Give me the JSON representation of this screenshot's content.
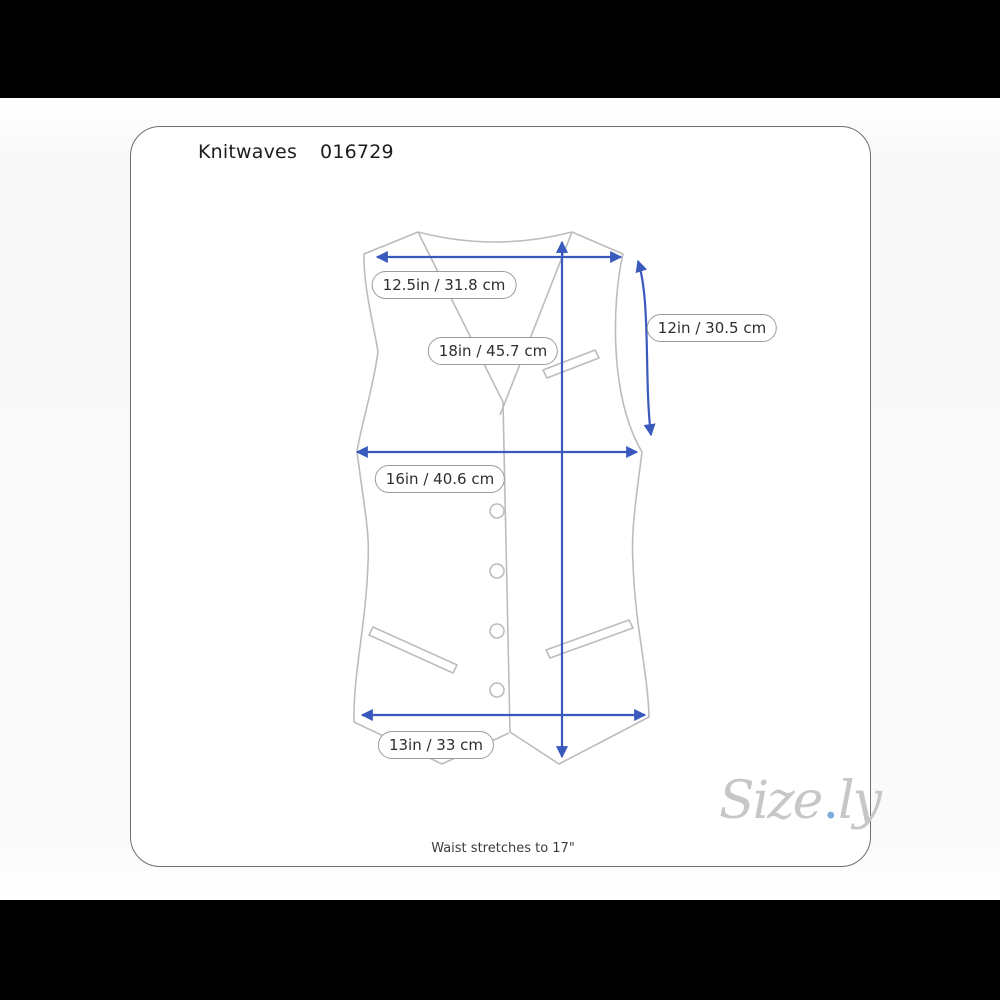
{
  "header": {
    "brand": "Knitwaves",
    "item_number": "016729"
  },
  "measurements": {
    "shoulder": {
      "label": "12.5in / 31.8 cm"
    },
    "length": {
      "label": "18in / 45.7 cm"
    },
    "armhole": {
      "label": "12in / 30.5 cm"
    },
    "chest": {
      "label": "16in / 40.6 cm"
    },
    "waist": {
      "label": "13in / 33 cm"
    }
  },
  "footer": {
    "note": "Waist stretches to 17\""
  },
  "logo": {
    "part1": "Size",
    "dot": ".",
    "part2": "ly"
  },
  "colors": {
    "arrow_blue": "#3a59bd",
    "garment_outline": "#bcbcbc",
    "pill_border": "#9c9c9c",
    "logo_gray": "#c7c7c7",
    "logo_dot_blue": "#7dabdc",
    "letterbox": "#000000",
    "card_background": "#ffffff"
  }
}
